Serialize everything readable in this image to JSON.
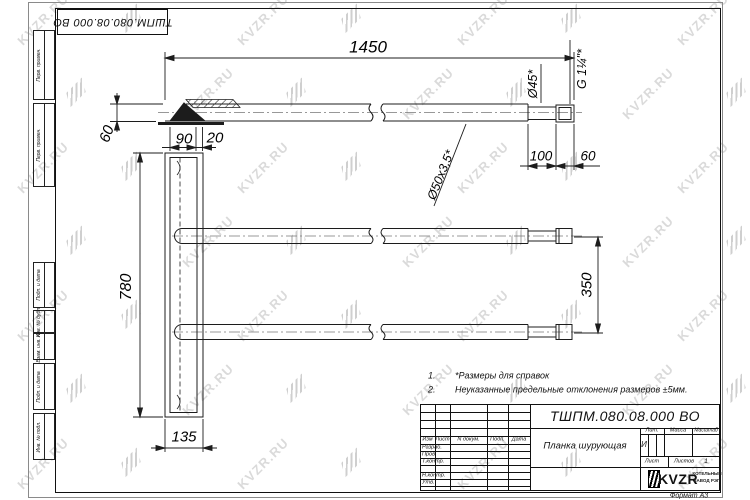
{
  "watermark": {
    "text": "KVZR.RU"
  },
  "stamp": {
    "doc_number": "ТШПМ.080.08.000 ВО"
  },
  "margin": {
    "cells": [
      {
        "label": "Перв. примен."
      },
      {
        "label": "Перв. примен."
      },
      {
        "label": "Подп. и дата"
      },
      {
        "label": "Инв. № дубл."
      },
      {
        "label": "Взам. инв. №"
      },
      {
        "label": "Подп. и дата"
      },
      {
        "label": "Инв. № подл."
      }
    ]
  },
  "dims": {
    "total_length": "1450",
    "offset_left": "60",
    "wedge_length": "90",
    "wedge_offset": "20",
    "pipe_spec": "Ø50x3,5*",
    "end_diameter": "Ø45*",
    "thread_spec": "G 1¼\"*",
    "end_length": "100",
    "thread_length": "60",
    "plank_height": "780",
    "plank_width": "135",
    "pipe_spacing": "350"
  },
  "notes": {
    "item1_num": "1.",
    "item1": "*Размеры для справок",
    "item2_num": "2.",
    "item2": "Неуказанные предельные отклонения размеров ±5мм."
  },
  "title_block": {
    "doc_number": "ТШПМ.080.08.000 ВО",
    "part_name": "Планка шурующая",
    "col_izm": "Изм",
    "col_list": "Лист",
    "col_doc": "N докум.",
    "col_podp": "Подп.",
    "col_data": "Дата",
    "row_razrab": "Разраб.",
    "row_prov": "Пров.",
    "row_tkontr": "Т.контр.",
    "row_nkontr": "Н.контр.",
    "row_utv": "Утв.",
    "lit_header": "Лит.",
    "mass_header": "Масса",
    "scale_header": "Масштаб",
    "lit_value": "И",
    "sheet_label": "Лист",
    "sheets_label": "Листов",
    "sheets_value": "1",
    "brand": "KVZR",
    "brand_line1": "КОТЕЛЬНЫЙ",
    "brand_line2": "ЗАВОД РЭП",
    "format_label": "Формат А3"
  }
}
